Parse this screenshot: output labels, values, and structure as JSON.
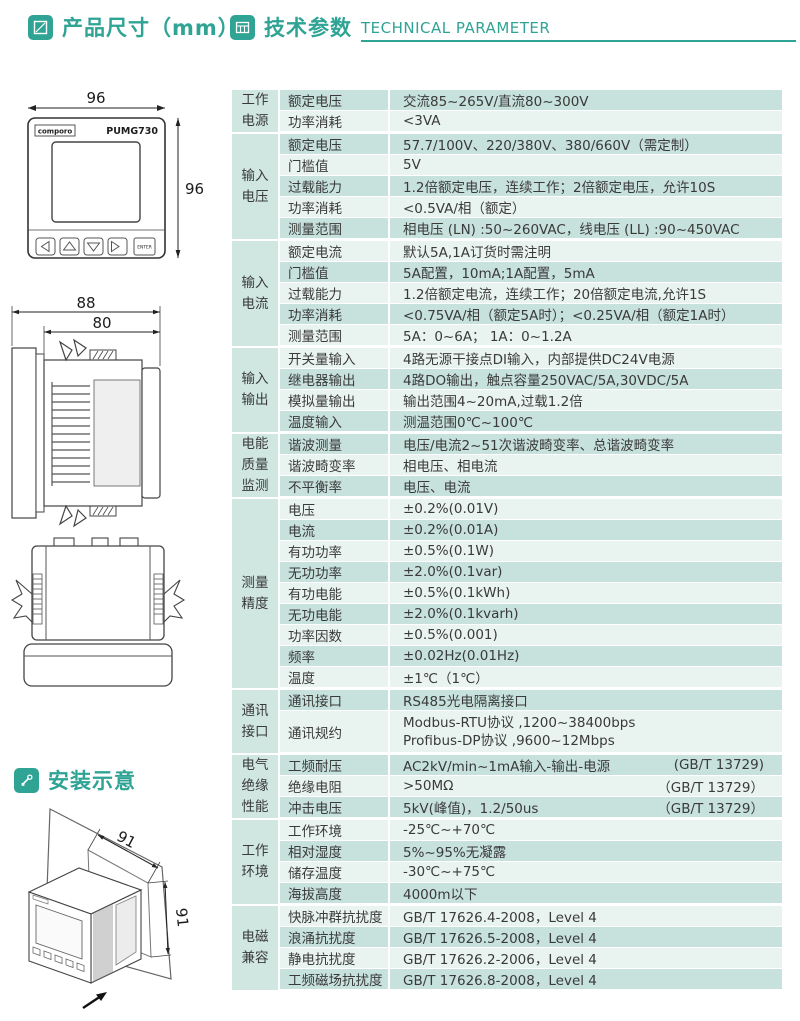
{
  "headers": {
    "product_size": "产品尺寸（mm）",
    "tech_cn": "技术参数",
    "tech_en": "TECHNICAL PARAMETER",
    "install": "安装示意"
  },
  "colors": {
    "accent": "#2fa394",
    "row_dark": "#c7e1dc",
    "row_light": "#e9f4f1",
    "group_cell": "#cfe6e1"
  },
  "drawings": {
    "front": {
      "brand": "comporo",
      "model": "PUMG730",
      "enter_label": "ENTER",
      "dim_width": "96",
      "dim_height": "96"
    },
    "side": {
      "dim_outer": "88",
      "dim_inner": "80"
    },
    "install": {
      "dim_w": "91",
      "dim_h": "91"
    }
  },
  "table": {
    "groups": [
      {
        "name": "工作电源",
        "rows": [
          {
            "label": "额定电压",
            "value": "交流85~265V/直流80~300V",
            "shade": "dk"
          },
          {
            "label": "功率消耗",
            "value": "<3VA",
            "shade": "lt"
          }
        ]
      },
      {
        "name": "输入电压",
        "rows": [
          {
            "label": "额定电压",
            "value": "57.7/100V、220/380V、380/660V（需定制）",
            "shade": "dk"
          },
          {
            "label": "门槛值",
            "value": "5V",
            "shade": "lt"
          },
          {
            "label": "过载能力",
            "value": "1.2倍额定电压，连续工作；2倍额定电压，允许10S",
            "shade": "dk"
          },
          {
            "label": "功率消耗",
            "value": "<0.5VA/相（额定）",
            "shade": "lt"
          },
          {
            "label": "测量范围",
            "value": "相电压 (LN) :50~260VAC，线电压 (LL) :90~450VAC",
            "shade": "dk"
          }
        ]
      },
      {
        "name": "输入电流",
        "rows": [
          {
            "label": "额定电流",
            "value": "默认5A,1A订货时需注明",
            "shade": "lt"
          },
          {
            "label": "门槛值",
            "value": "5A配置，10mA;1A配置，5mA",
            "shade": "dk"
          },
          {
            "label": "过载能力",
            "value": "1.2倍额定电流，连续工作；20倍额定电流,允许1S",
            "shade": "lt"
          },
          {
            "label": "功率消耗",
            "value": "<0.75VA/相（额定5A时）；<0.25VA/相（额定1A时）",
            "shade": "dk"
          },
          {
            "label": "测量范围",
            "value": "5A：0~6A；  1A：0~1.2A",
            "shade": "lt"
          }
        ]
      },
      {
        "name": "输入输出",
        "rows": [
          {
            "label": "开关量输入",
            "value": "4路无源干接点DI输入，内部提供DC24V电源",
            "shade": "lt"
          },
          {
            "label": "继电器输出",
            "value": "4路DO输出，触点容量250VAC/5A,30VDC/5A",
            "shade": "dk"
          },
          {
            "label": "模拟量输出",
            "value": "输出范围4~20mA,过载1.2倍",
            "shade": "lt"
          },
          {
            "label": "温度输入",
            "value": "测温范围0℃~100℃",
            "shade": "dk"
          }
        ]
      },
      {
        "name": "电能质量监测",
        "rows": [
          {
            "label": "谐波测量",
            "value": "电压/电流2~51次谐波畸变率、总谐波畸变率",
            "shade": "dk"
          },
          {
            "label": "谐波畸变率",
            "value": "相电压、相电流",
            "shade": "lt"
          },
          {
            "label": "不平衡率",
            "value": "电压、电流",
            "shade": "dk"
          }
        ]
      },
      {
        "name": "测量精度",
        "rows": [
          {
            "label": "电压",
            "value": "±0.2%(0.01V)",
            "shade": "lt"
          },
          {
            "label": "电流",
            "value": "±0.2%(0.01A)",
            "shade": "dk"
          },
          {
            "label": "有功功率",
            "value": "±0.5%(0.1W)",
            "shade": "lt"
          },
          {
            "label": "无功功率",
            "value": "±2.0%(0.1var)",
            "shade": "dk"
          },
          {
            "label": "有功电能",
            "value": "±0.5%(0.1kWh)",
            "shade": "lt"
          },
          {
            "label": "无功电能",
            "value": "±2.0%(0.1kvarh)",
            "shade": "dk"
          },
          {
            "label": "功率因数",
            "value": "±0.5%(0.001)",
            "shade": "lt"
          },
          {
            "label": "频率",
            "value": "±0.02Hz(0.01Hz)",
            "shade": "dk"
          },
          {
            "label": "温度",
            "value": "±1℃（1℃）",
            "shade": "lt"
          }
        ]
      },
      {
        "name": "通讯接口",
        "rows": [
          {
            "label": "通讯接口",
            "value": "RS485光电隔离接口",
            "shade": "dk"
          },
          {
            "label": "通讯规约",
            "lines": [
              "Modbus-RTU协议 ,1200~38400bps",
              "Profibus-DP协议 ,9600~12Mbps"
            ],
            "shade": "lt"
          }
        ]
      },
      {
        "name": "电气绝缘性能",
        "rows": [
          {
            "label": "工频耐压",
            "value": "AC2kV/min~1mA输入-输出-电源",
            "note": "(GB/T 13729)",
            "shade": "dk"
          },
          {
            "label": "绝缘电阻",
            "value": ">50MΩ",
            "note": "（GB/T 13729）",
            "shade": "lt"
          },
          {
            "label": "冲击电压",
            "value": "5kV(峰值)，1.2/50us",
            "note": "（GB/T 13729）",
            "shade": "dk"
          }
        ]
      },
      {
        "name": "工作环境",
        "rows": [
          {
            "label": "工作环境",
            "value": "-25℃~+70℃",
            "shade": "lt"
          },
          {
            "label": "相对湿度",
            "value": "5%~95%无凝露",
            "shade": "dk"
          },
          {
            "label": "储存温度",
            "value": "-30℃~+75℃",
            "shade": "lt"
          },
          {
            "label": "海拔高度",
            "value": "4000m以下",
            "shade": "dk"
          }
        ]
      },
      {
        "name": "电磁兼容",
        "rows": [
          {
            "label": "快脉冲群抗扰度",
            "value": "GB/T 17626.4-2008，Level 4",
            "shade": "lt"
          },
          {
            "label": "浪涌抗扰度",
            "value": "GB/T 17626.5-2008，Level 4",
            "shade": "dk"
          },
          {
            "label": "静电抗扰度",
            "value": "GB/T 17626.2-2006，Level 4",
            "shade": "lt"
          },
          {
            "label": "工频磁场抗扰度",
            "value": "GB/T 17626.8-2008，Level 4",
            "shade": "dk"
          }
        ]
      }
    ]
  }
}
